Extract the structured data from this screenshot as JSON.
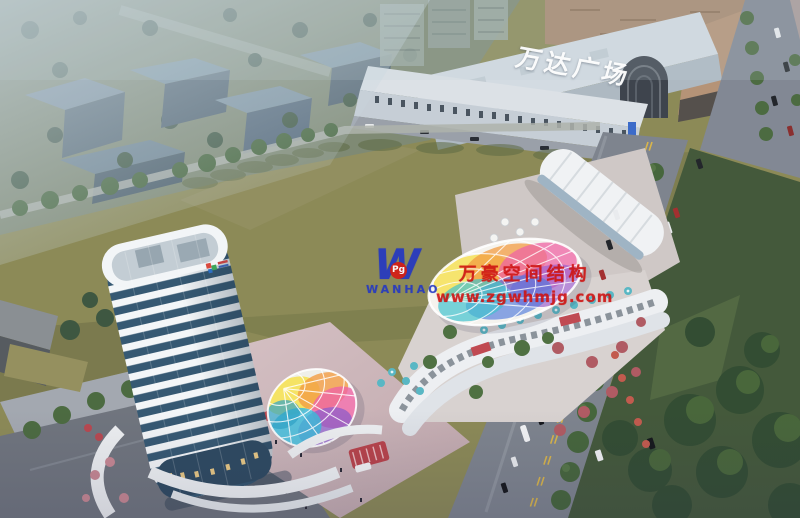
{
  "scene": {
    "alt": "Aerial dusk rendering of a mixed-use retail complex: curved white high-rise tower with rainbow glass canopies, strip retail with terraces, large green field, arterial road with buses, and Wanda Plaza mall behind"
  },
  "mall": {
    "sign_text": "万达广场"
  },
  "watermark": {
    "logo_letter": "W",
    "logo_badge": "Pg",
    "logo_name": "WANHAO",
    "line1": "万豪空间结构",
    "line2": "www.zgwhmjg.com",
    "text_color": "#CE1312",
    "logo_color": "#2438C2"
  },
  "palette": {
    "field_olive": "#8C8A57",
    "lawn_dark": "#44593B",
    "road_gray": "#7E848E",
    "tower_glass": "#365973",
    "tower_white": "#F3F6F8",
    "accent_red": "#B8434B",
    "umbrella_teal": "#59B7C4",
    "rainbow": [
      "#F6E04E",
      "#F29C43",
      "#EE64A4",
      "#9E62CE",
      "#4E79DB",
      "#41C2CF"
    ]
  }
}
